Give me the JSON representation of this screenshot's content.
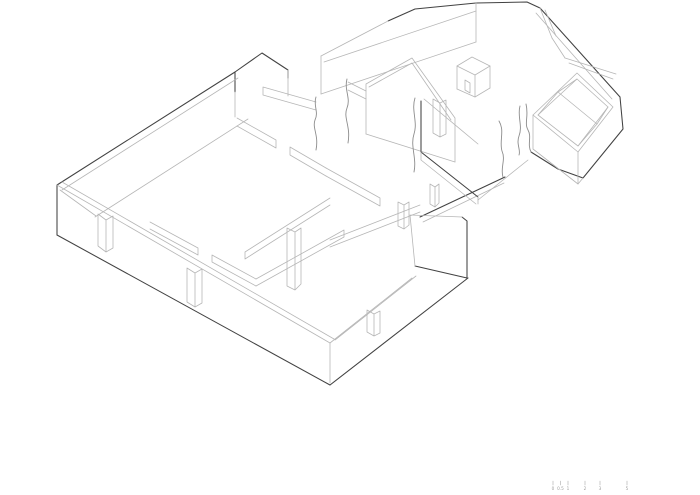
{
  "meta": {
    "description": "Axonometric (isometric) line drawing of a ruined masonry building complex, shown as roofless wall shells with door and window openings and torn break edges",
    "background_color": "#ffffff"
  },
  "drawing": {
    "stroke_light": "#b6b6b6",
    "stroke_medium": "#8c8c8c",
    "stroke_dark": "#424242",
    "parts": [
      "main-building-shell",
      "middle-wing-gable-wall",
      "right-wing-square-room",
      "wall-break-lines"
    ]
  },
  "scale_bar": {
    "labels": [
      "0",
      "0.5",
      "1",
      "2",
      "3",
      "5"
    ],
    "tick_color": "#a8a8a8",
    "label_color": "#9d9d9d"
  }
}
